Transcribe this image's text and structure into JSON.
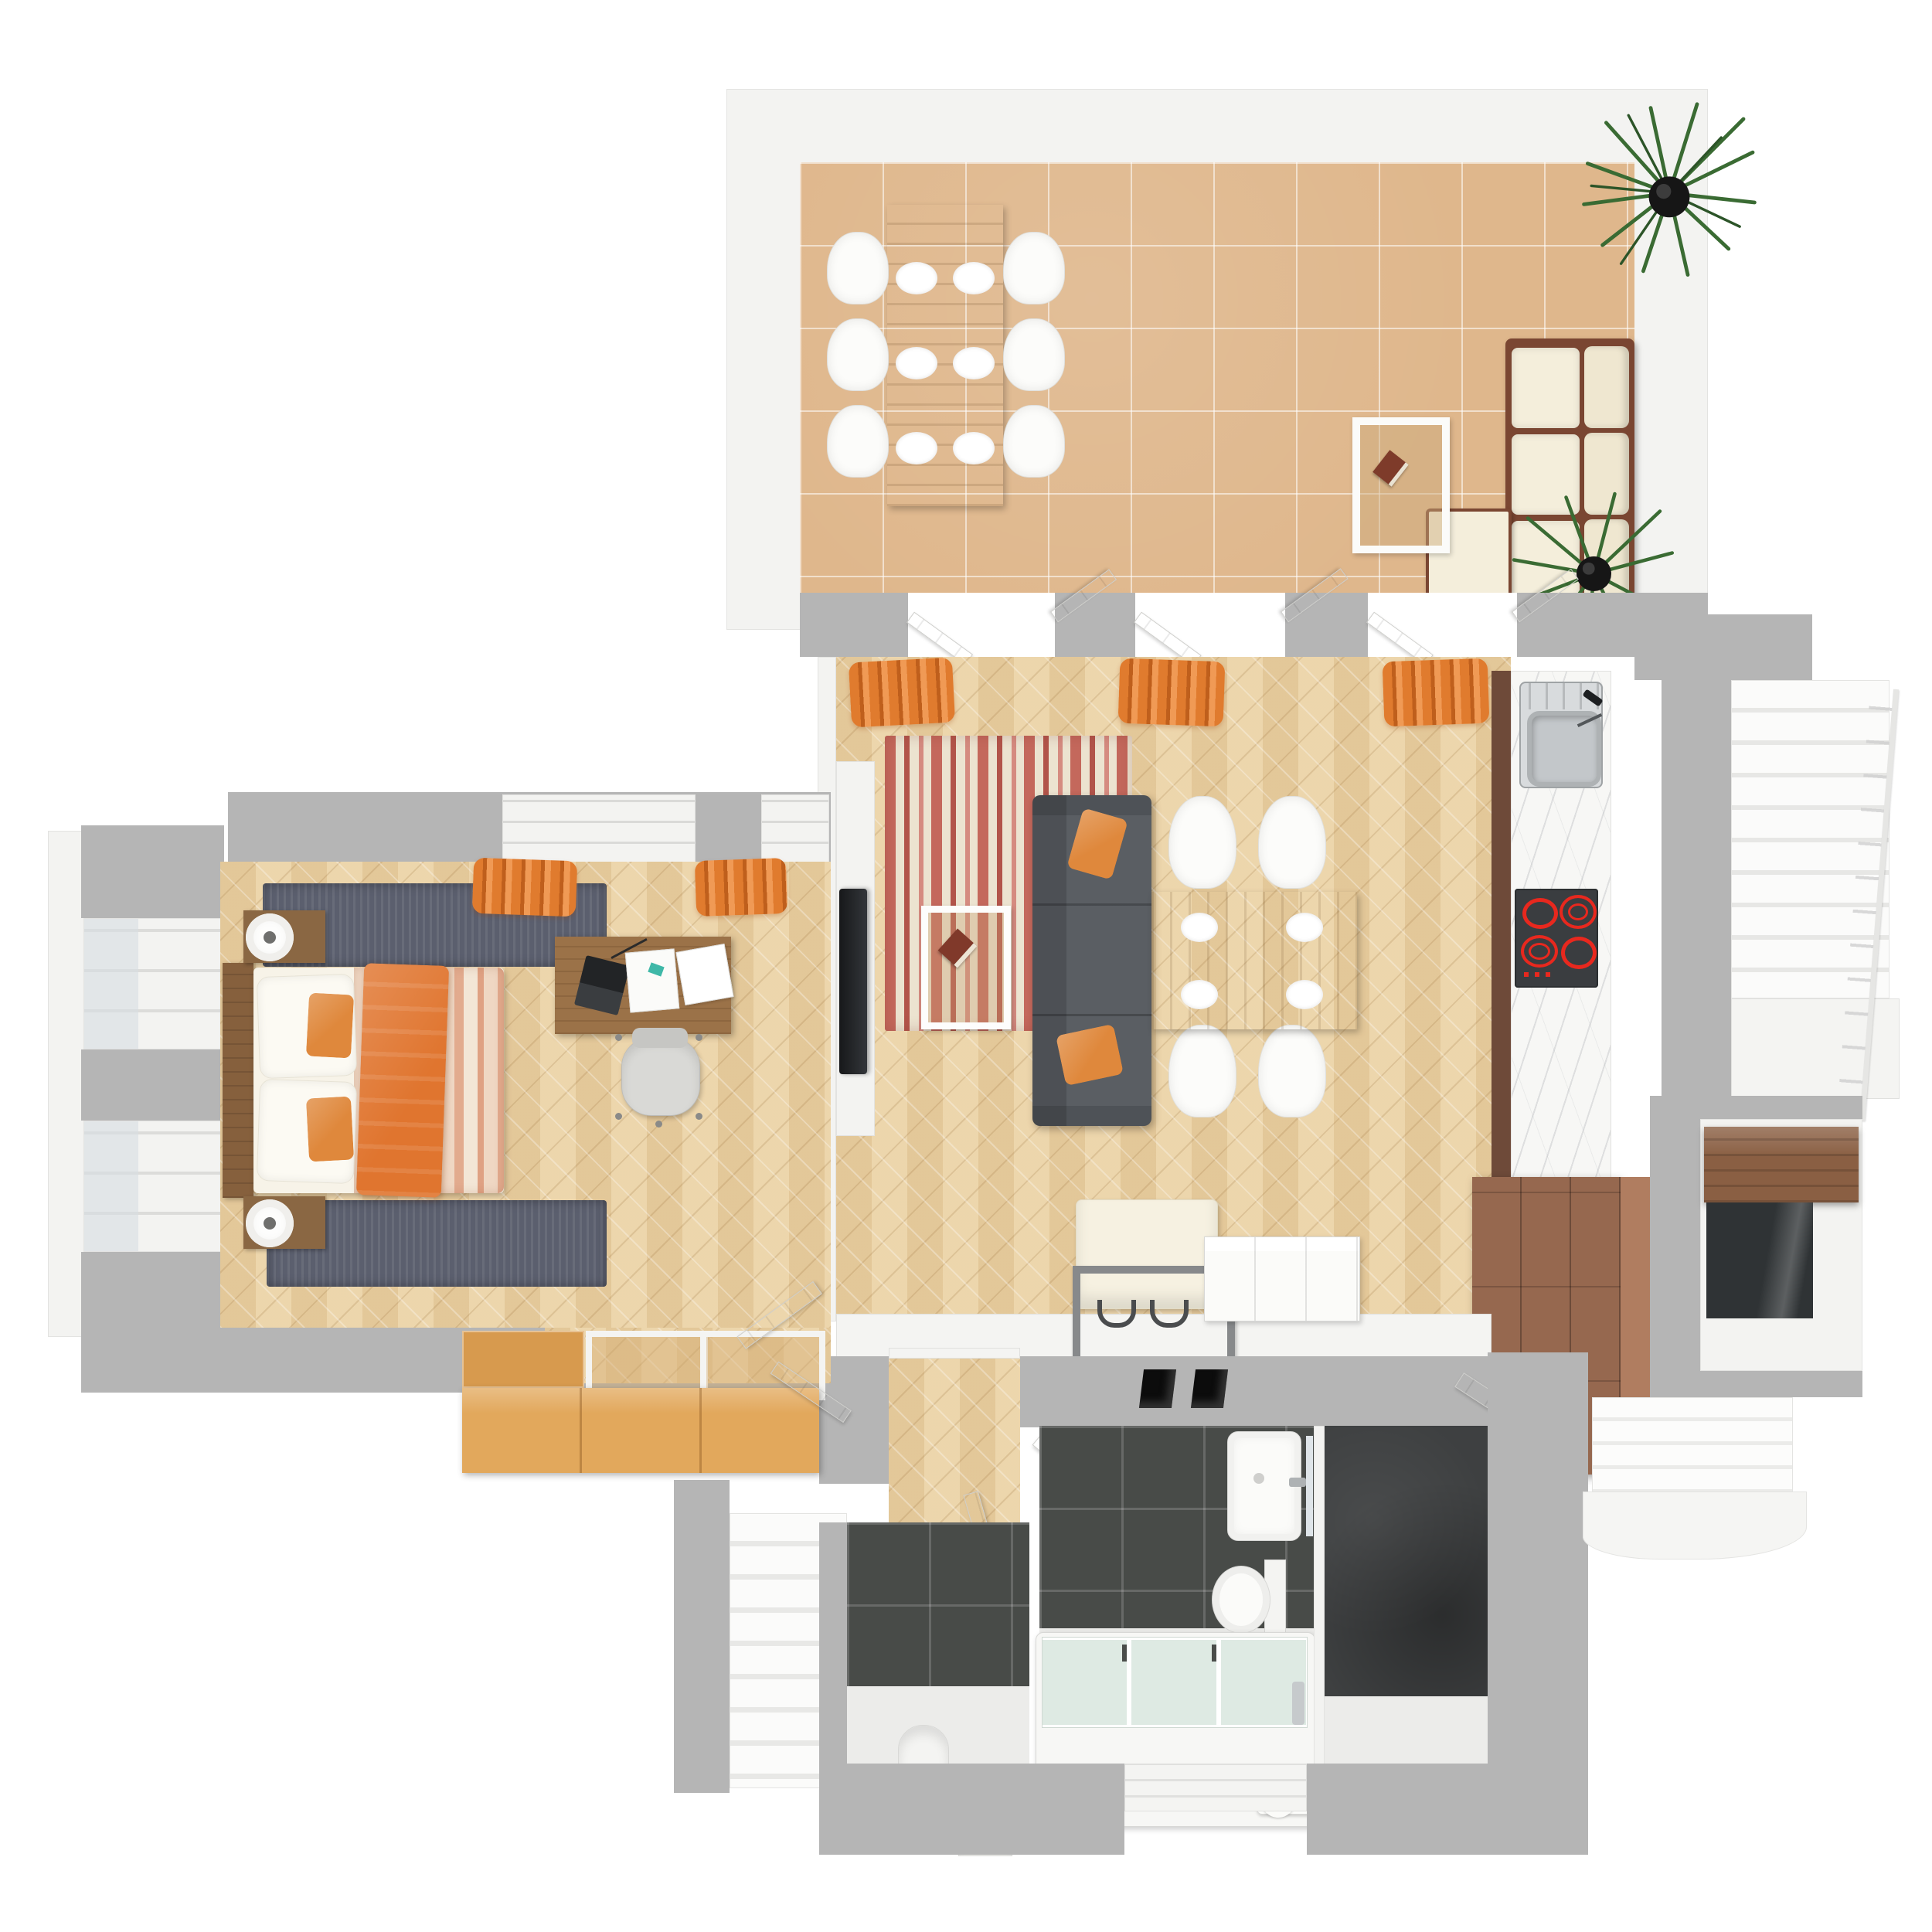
{
  "scene": {
    "kind": "3d-floor-plan-top-view",
    "background_color": "#ffffff",
    "no_visible_text": true
  },
  "palette": {
    "cut_wall_gray": "#b5b5b5",
    "outer_wall_white": "#f3f3f1",
    "terrace_tile": "#dfb78c",
    "parquet_herringbone": "#ead2a7",
    "dark_wall_tile": "#484b48",
    "concrete_floor": "#3e4041",
    "marble_counter": "#f7f7f5",
    "kitchen_cabinet_brown": "#96684f",
    "sofa_gray": "#5a5e63",
    "accent_orange": "#e0792e",
    "rug_stripe_red": "#c4685c",
    "rug_stripe_cream": "#ece3d0",
    "bed_runner_gray": "#5b5f6e",
    "oak_chest": "#e2a85c",
    "hob_ring_red": "#e8281e",
    "plant_green": "#3a6b33"
  },
  "rooms": [
    {
      "id": "terrace",
      "floor": "terracotta-tile",
      "items": [
        {
          "name": "outdoor-dining-table",
          "material": "wood"
        },
        {
          "name": "terrace-chair",
          "count": 6
        },
        {
          "name": "place-setting-plate",
          "count": 6
        },
        {
          "name": "outdoor-sofa",
          "frame": "dark-wood",
          "cushions": "cream",
          "sections": 3,
          "ottoman": 1
        },
        {
          "name": "side-table",
          "on_top": [
            "book"
          ]
        },
        {
          "name": "potted-palm-plant",
          "count": 2
        }
      ]
    },
    {
      "id": "living-kitchen",
      "floor": "herringbone-parquet",
      "items": [
        {
          "name": "french-door-opening",
          "count": 3,
          "curtains": "orange"
        },
        {
          "name": "striped-rug",
          "colors": [
            "red",
            "cream"
          ]
        },
        {
          "name": "coffee-table",
          "on_top": [
            "book"
          ]
        },
        {
          "name": "sofa",
          "color": "dark-gray",
          "pillows": 2
        },
        {
          "name": "tv-on-media-wall"
        },
        {
          "name": "dining-table",
          "seats": 4,
          "plates": 4
        },
        {
          "name": "dining-chair",
          "count": 4
        },
        {
          "name": "kitchen-counter",
          "features": [
            "sink",
            "faucet",
            "induction-hob-4-burners"
          ]
        },
        {
          "name": "tall-cabinet",
          "color": "brown"
        },
        {
          "name": "entry-bench",
          "cushion": "cream"
        },
        {
          "name": "sideboard",
          "color": "white"
        },
        {
          "name": "wall-vent",
          "count": 2
        }
      ]
    },
    {
      "id": "bedroom",
      "floor": "herringbone-parquet",
      "items": [
        {
          "name": "double-bed",
          "duvet": "striped-pink",
          "blanket": "orange",
          "pillows_white": 2,
          "pillows_orange": 2
        },
        {
          "name": "nightstand",
          "count": 2,
          "lamps": 2
        },
        {
          "name": "bedside-runner-rug",
          "count": 2,
          "color": "gray-blue"
        },
        {
          "name": "desk",
          "on_top": [
            "laptop",
            "papers",
            "notebook",
            "pens"
          ]
        },
        {
          "name": "office-chair"
        },
        {
          "name": "window-bay",
          "count": 2,
          "wall": "left"
        },
        {
          "name": "orange-curtains",
          "count": 2
        },
        {
          "name": "oak-chest-with-glass-tops"
        }
      ]
    },
    {
      "id": "hallway",
      "floor": "herringbone-parquet",
      "items": [
        {
          "name": "interior-door",
          "count": 4
        }
      ]
    },
    {
      "id": "bathroom",
      "walls": "dark-tile",
      "items": [
        {
          "name": "bathtub-with-glass-screen"
        },
        {
          "name": "toilet"
        },
        {
          "name": "washbasin"
        },
        {
          "name": "towel-holder"
        }
      ]
    },
    {
      "id": "wc",
      "walls": "dark-tile",
      "items": [
        {
          "name": "toilet"
        },
        {
          "name": "small-basin-unit"
        }
      ]
    },
    {
      "id": "storage-room",
      "floor": "concrete",
      "items": [
        {
          "name": "door"
        }
      ]
    },
    {
      "id": "staircase-up",
      "treads": 10,
      "railing": "right"
    },
    {
      "id": "staircase-down",
      "treads": 6,
      "landing": "curved"
    },
    {
      "id": "entry-stairs-down",
      "treads": 6
    },
    {
      "id": "stair-niche",
      "items": [
        {
          "name": "wooden-shelf"
        }
      ]
    }
  ]
}
